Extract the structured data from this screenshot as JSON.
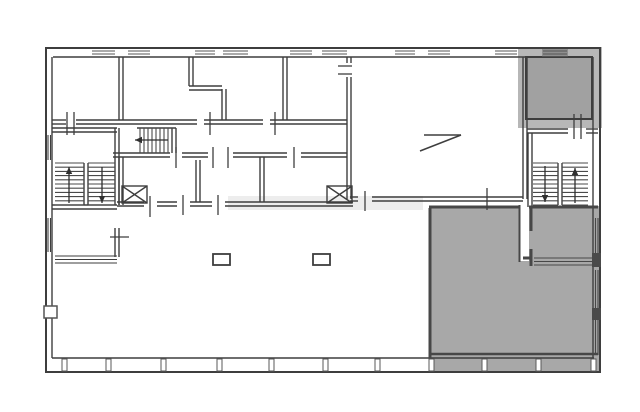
{
  "canvas": {
    "width": 640,
    "height": 412,
    "background": "#ffffff"
  },
  "colors": {
    "wall": "#3e3e3e",
    "gray_wall": "#474747",
    "gray_frame": "#b7b7b7",
    "gray_room": "#a1a1a1",
    "gray_area": "#a8a8a8",
    "pier": "#4a4a4a",
    "white": "#ffffff"
  },
  "plan": {
    "elements": [
      {
        "t": "rect",
        "name": "gray-frame-top-right",
        "x": 518,
        "y": 47,
        "w": 84,
        "h": 81,
        "fill": "#b7b7b7"
      },
      {
        "t": "rect",
        "name": "gray-room-top-right",
        "x": 526,
        "y": 57,
        "w": 66,
        "h": 62,
        "fill": "#a1a1a1",
        "stroke": "#3d3d3d",
        "sw": 2
      },
      {
        "t": "rect",
        "name": "gray-area-bottom-right",
        "x": 429,
        "y": 206,
        "w": 170,
        "h": 166,
        "fill": "#a8a8a8"
      },
      {
        "t": "rect",
        "name": "stair-access-strip",
        "x": 519,
        "y": 133,
        "w": 10,
        "h": 128,
        "fill": "#ffffff"
      },
      {
        "t": "rect",
        "name": "watermark",
        "x": 228,
        "y": 196,
        "w": 195,
        "h": 14,
        "fill": "#cccccc",
        "op": 0.35
      },
      {
        "t": "rect",
        "name": "window-dark-top-right",
        "x": 542,
        "y": 48,
        "w": 26,
        "h": 9,
        "fill": "#8f8f8f"
      },
      {
        "t": "rect",
        "name": "outer-wall",
        "x": 46,
        "y": 48,
        "w": 554,
        "h": 324,
        "fill": "none",
        "stroke": "#3e3e3e",
        "sw": 2
      },
      {
        "t": "line",
        "name": "inner-wall-top",
        "x1": 53,
        "y1": 57,
        "x2": 593,
        "y2": 57,
        "w": 1.4
      },
      {
        "t": "line",
        "name": "inner-wall-left",
        "x1": 52,
        "y1": 57,
        "x2": 52,
        "y2": 358,
        "w": 1.4
      },
      {
        "t": "line",
        "name": "inner-wall-right",
        "x1": 593,
        "y1": 57,
        "x2": 593,
        "y2": 358,
        "w": 1.4
      },
      {
        "t": "line",
        "name": "inner-wall-bottom",
        "x1": 52,
        "y1": 358,
        "x2": 594,
        "y2": 358,
        "w": 1.4
      },
      {
        "t": "topwins",
        "name": "top-window",
        "spans": [
          [
            92,
            115
          ],
          [
            128,
            150
          ],
          [
            195,
            215
          ],
          [
            223,
            248
          ],
          [
            290,
            312
          ],
          [
            322,
            347
          ],
          [
            395,
            415
          ],
          [
            428,
            450
          ],
          [
            495,
            517
          ],
          [
            543,
            567
          ]
        ],
        "ya": 51,
        "yb": 54
      },
      {
        "t": "mullions",
        "name": "bottom-mullion",
        "xs": [
          62,
          106,
          161,
          217,
          269,
          323,
          375,
          429,
          482,
          536,
          591
        ],
        "y": 359,
        "h": 12
      },
      {
        "t": "dwall",
        "name": "wall-topband-bottom",
        "x1": 52,
        "y1": 120,
        "x2": 66,
        "y2": 120
      },
      {
        "t": "dwall",
        "name": "wall-topband-bottom",
        "x1": 76,
        "y1": 120,
        "x2": 197,
        "y2": 120
      },
      {
        "t": "dwall",
        "name": "wall-topband-bottom",
        "x1": 204,
        "y1": 120,
        "x2": 263,
        "y2": 120
      },
      {
        "t": "dwall",
        "name": "wall-topband-bottom",
        "x1": 270,
        "y1": 120,
        "x2": 347,
        "y2": 120
      },
      {
        "t": "dwall",
        "name": "wall-room1-right",
        "x1": 119,
        "y1": 57,
        "x2": 119,
        "y2": 120
      },
      {
        "t": "dwall",
        "name": "wall-room2-right-upper",
        "x1": 189,
        "y1": 57,
        "x2": 189,
        "y2": 86
      },
      {
        "t": "dwall",
        "name": "wall-room2-step",
        "x1": 189,
        "y1": 86,
        "x2": 222,
        "y2": 86
      },
      {
        "t": "dwall",
        "name": "wall-room2-right-lower",
        "x1": 222,
        "y1": 89,
        "x2": 222,
        "y2": 120
      },
      {
        "t": "dwall",
        "name": "wall-room3-right",
        "x1": 283,
        "y1": 57,
        "x2": 283,
        "y2": 120
      },
      {
        "t": "dwall",
        "name": "wall-bigroom-left",
        "x1": 347,
        "y1": 77,
        "x2": 347,
        "y2": 199
      },
      {
        "t": "dwall",
        "name": "wall-bigroom-left-stub",
        "x1": 347,
        "y1": 57,
        "x2": 347,
        "y2": 63
      },
      {
        "t": "dwall",
        "name": "wall-bigroom-right",
        "x1": 523,
        "y1": 57,
        "x2": 523,
        "y2": 199
      },
      {
        "t": "dwall",
        "name": "wall-bigroom-bottom",
        "x1": 350,
        "y1": 197,
        "x2": 358,
        "y2": 197
      },
      {
        "t": "dwall",
        "name": "wall-bigroom-bottom",
        "x1": 372,
        "y1": 197,
        "x2": 523,
        "y2": 197
      },
      {
        "t": "dwall",
        "name": "wall-corridor-bottom",
        "x1": 113,
        "y1": 153,
        "x2": 170,
        "y2": 153
      },
      {
        "t": "dwall",
        "name": "wall-corridor-bottom",
        "x1": 182,
        "y1": 153,
        "x2": 208,
        "y2": 153
      },
      {
        "t": "dwall",
        "name": "wall-corridor-bottom",
        "x1": 233,
        "y1": 153,
        "x2": 287,
        "y2": 153
      },
      {
        "t": "dwall",
        "name": "wall-corridor-bottom",
        "x1": 301,
        "y1": 153,
        "x2": 347,
        "y2": 153
      },
      {
        "t": "dwall",
        "name": "wall-landing-top",
        "x1": 52,
        "y1": 128,
        "x2": 117,
        "y2": 128
      },
      {
        "t": "dwall",
        "name": "wall-leftstair-right",
        "x1": 115,
        "y1": 128,
        "x2": 115,
        "y2": 205
      },
      {
        "t": "dwall",
        "name": "wall-leftstair-bottom",
        "x1": 52,
        "y1": 205,
        "x2": 117,
        "y2": 205
      },
      {
        "t": "dwall",
        "name": "wall-leftroom-right",
        "x1": 115,
        "y1": 228,
        "x2": 115,
        "y2": 257
      },
      {
        "t": "dwall",
        "name": "wall-midband-left",
        "x1": 119,
        "y1": 157,
        "x2": 119,
        "y2": 205
      },
      {
        "t": "dwall",
        "name": "wall-midband-1",
        "x1": 196,
        "y1": 160,
        "x2": 196,
        "y2": 202
      },
      {
        "t": "dwall",
        "name": "wall-midband-2",
        "x1": 260,
        "y1": 157,
        "x2": 260,
        "y2": 202
      },
      {
        "t": "dwall",
        "name": "wall-midband-bottom",
        "x1": 117,
        "y1": 202,
        "x2": 144,
        "y2": 202
      },
      {
        "t": "dwall",
        "name": "wall-midband-bottom",
        "x1": 157,
        "y1": 202,
        "x2": 177,
        "y2": 202
      },
      {
        "t": "dwall",
        "name": "wall-midband-bottom",
        "x1": 190,
        "y1": 202,
        "x2": 212,
        "y2": 202
      },
      {
        "t": "dwall",
        "name": "wall-midband-bottom",
        "x1": 225,
        "y1": 202,
        "x2": 353,
        "y2": 202
      },
      {
        "t": "dwall",
        "name": "wall-leftstair-divider",
        "x1": 84,
        "y1": 163,
        "x2": 84,
        "y2": 205
      },
      {
        "t": "dwall",
        "name": "wall-rightstair-divider",
        "x1": 558,
        "y1": 163,
        "x2": 558,
        "y2": 205
      },
      {
        "t": "dwall",
        "name": "wall-midstair-right",
        "x1": 172,
        "y1": 128,
        "x2": 172,
        "y2": 153
      },
      {
        "t": "line",
        "name": "wall-midstair-top",
        "x1": 137,
        "y1": 128,
        "x2": 176,
        "y2": 128,
        "w": 1.4
      },
      {
        "t": "dwall",
        "name": "wall-stairwell-top",
        "x1": 527,
        "y1": 129,
        "x2": 568,
        "y2": 129
      },
      {
        "t": "dwall",
        "name": "wall-stairwell-top",
        "x1": 586,
        "y1": 129,
        "x2": 598,
        "y2": 129
      },
      {
        "t": "dwall",
        "name": "wall-stairwell-left",
        "x1": 528,
        "y1": 133,
        "x2": 528,
        "y2": 207
      },
      {
        "t": "wlines",
        "name": "window-band-leftroom",
        "dir": "h",
        "a1": 55,
        "a2": 117,
        "ks": [
          256,
          259.5,
          263
        ]
      },
      {
        "t": "wlines",
        "name": "window-band-leftwall-landing",
        "dir": "v",
        "a1": 135,
        "a2": 160,
        "ks": [
          48,
          50.5
        ]
      },
      {
        "t": "wlines",
        "name": "window-band-leftwall-lower",
        "dir": "v",
        "a1": 218,
        "a2": 252,
        "ks": [
          48,
          50.5
        ]
      },
      {
        "t": "line",
        "name": "gray-wall-top",
        "x1": 429,
        "y1": 207,
        "x2": 519,
        "y2": 207,
        "w": 3,
        "c": "#474747"
      },
      {
        "t": "line",
        "name": "gray-wall-top",
        "x1": 529,
        "y1": 207,
        "x2": 598,
        "y2": 207,
        "w": 3,
        "c": "#474747"
      },
      {
        "t": "line",
        "name": "gray-wall-left",
        "x1": 430,
        "y1": 208,
        "x2": 430,
        "y2": 358,
        "w": 3,
        "c": "#474747"
      },
      {
        "t": "line",
        "name": "gray-strip-edge",
        "x1": 519.5,
        "y1": 205,
        "x2": 519.5,
        "y2": 262,
        "w": 2,
        "c": "#474747"
      },
      {
        "t": "line",
        "name": "gray-subroom-wall",
        "x1": 531,
        "y1": 208,
        "x2": 531,
        "y2": 231,
        "w": 3,
        "c": "#474747"
      },
      {
        "t": "line",
        "name": "gray-subroom-wall",
        "x1": 531,
        "y1": 249,
        "x2": 531,
        "y2": 266,
        "w": 3,
        "c": "#474747"
      },
      {
        "t": "line",
        "name": "gray-subroom-foot",
        "x1": 523,
        "y1": 258,
        "x2": 531,
        "y2": 258,
        "w": 3,
        "c": "#474747"
      },
      {
        "t": "wlines",
        "name": "window-band-subroom",
        "dir": "h",
        "a1": 534,
        "a2": 592,
        "ks": [
          258,
          261.5,
          265
        ],
        "c": "#474747"
      },
      {
        "t": "wlines",
        "name": "window-band-right-1",
        "dir": "v",
        "a1": 218,
        "a2": 253,
        "ks": [
          595.5,
          598
        ],
        "c": "#474747"
      },
      {
        "t": "wlines",
        "name": "window-band-right-2",
        "dir": "v",
        "a1": 270,
        "a2": 310,
        "ks": [
          595.5,
          598
        ],
        "c": "#474747"
      },
      {
        "t": "wlines",
        "name": "window-band-right-3",
        "dir": "v",
        "a1": 320,
        "a2": 355,
        "ks": [
          595.5,
          598
        ],
        "c": "#474747"
      },
      {
        "t": "rect",
        "name": "wall-pier",
        "x": 592,
        "y": 253,
        "w": 9,
        "h": 14,
        "fill": "#4a4a4a"
      },
      {
        "t": "rect",
        "name": "wall-pier",
        "x": 592,
        "y": 308,
        "w": 9,
        "h": 12,
        "fill": "#4a4a4a"
      },
      {
        "t": "line",
        "name": "gray-wall-bottom",
        "x1": 430,
        "y1": 354,
        "x2": 598,
        "y2": 354,
        "w": 2.5,
        "c": "#474747"
      },
      {
        "t": "stair",
        "name": "stair-left-up-flight",
        "x": 55,
        "y": 163,
        "w": 29,
        "h": 42,
        "n": 10,
        "dir": "h"
      },
      {
        "t": "stair",
        "name": "stair-left-down-flight",
        "x": 88,
        "y": 163,
        "w": 27,
        "h": 42,
        "n": 10,
        "dir": "h"
      },
      {
        "t": "stair",
        "name": "stair-corridor-flight",
        "x": 140,
        "y": 128,
        "w": 32,
        "h": 25,
        "n": 8,
        "dir": "v"
      },
      {
        "t": "stair",
        "name": "stair-right-down-flight",
        "x": 533,
        "y": 163,
        "w": 25,
        "h": 42,
        "n": 10,
        "dir": "h"
      },
      {
        "t": "stair",
        "name": "stair-right-up-flight",
        "x": 562,
        "y": 163,
        "w": 26,
        "h": 42,
        "n": 10,
        "dir": "h"
      },
      {
        "t": "arrow",
        "name": "stair-arrow-up",
        "x1": 69,
        "y1": 203,
        "x2": 69,
        "y2": 167
      },
      {
        "t": "arrow",
        "name": "stair-arrow-down",
        "x1": 102,
        "y1": 167,
        "x2": 102,
        "y2": 203
      },
      {
        "t": "arrow",
        "name": "stair-arrow-left",
        "x1": 168,
        "y1": 140,
        "x2": 135,
        "y2": 140
      },
      {
        "t": "arrow",
        "name": "stair-arrow-down",
        "x1": 545,
        "y1": 166,
        "x2": 545,
        "y2": 202
      },
      {
        "t": "arrow",
        "name": "stair-arrow-up",
        "x1": 575,
        "y1": 203,
        "x2": 575,
        "y2": 168
      },
      {
        "t": "xbox",
        "name": "shaft-x-left",
        "x": 122,
        "y": 186,
        "w": 25,
        "h": 17
      },
      {
        "t": "xbox",
        "name": "shaft-x-right",
        "x": 327,
        "y": 186,
        "w": 25,
        "h": 17
      },
      {
        "t": "rect",
        "name": "column",
        "x": 213,
        "y": 254,
        "w": 17,
        "h": 11,
        "fill": "#ffffff",
        "stroke": "#3e3e3e",
        "sw": 1.8
      },
      {
        "t": "rect",
        "name": "column",
        "x": 313,
        "y": 254,
        "w": 17,
        "h": 11,
        "fill": "#ffffff",
        "stroke": "#3e3e3e",
        "sw": 1.8
      },
      {
        "t": "line",
        "name": "ramp-symbol",
        "x1": 424,
        "y1": 135,
        "x2": 461,
        "y2": 135,
        "w": 1.5
      },
      {
        "t": "line",
        "name": "ramp-symbol",
        "x1": 420,
        "y1": 151,
        "x2": 461,
        "y2": 135,
        "w": 1.5
      },
      {
        "t": "line",
        "name": "door-tick",
        "x1": 67,
        "y1": 112,
        "x2": 67,
        "y2": 135,
        "w": 1.3
      },
      {
        "t": "line",
        "name": "door-tick",
        "x1": 74,
        "y1": 112,
        "x2": 74,
        "y2": 135,
        "w": 1.3
      },
      {
        "t": "line",
        "name": "door-tick",
        "x1": 210,
        "y1": 112,
        "x2": 210,
        "y2": 135,
        "w": 1.3
      },
      {
        "t": "line",
        "name": "door-tick",
        "x1": 275,
        "y1": 112,
        "x2": 275,
        "y2": 135,
        "w": 1.3
      },
      {
        "t": "line",
        "name": "door-tick",
        "x1": 338,
        "y1": 66,
        "x2": 352,
        "y2": 66,
        "w": 1.3
      },
      {
        "t": "line",
        "name": "door-tick",
        "x1": 338,
        "y1": 74,
        "x2": 352,
        "y2": 74,
        "w": 1.3
      },
      {
        "t": "line",
        "name": "door-tick",
        "x1": 176,
        "y1": 147,
        "x2": 176,
        "y2": 168,
        "w": 1.3
      },
      {
        "t": "line",
        "name": "door-tick",
        "x1": 213,
        "y1": 147,
        "x2": 213,
        "y2": 168,
        "w": 1.3
      },
      {
        "t": "line",
        "name": "door-tick",
        "x1": 228,
        "y1": 147,
        "x2": 228,
        "y2": 168,
        "w": 1.3
      },
      {
        "t": "line",
        "name": "door-tick",
        "x1": 294,
        "y1": 147,
        "x2": 294,
        "y2": 168,
        "w": 1.3
      },
      {
        "t": "line",
        "name": "door-tick",
        "x1": 150,
        "y1": 196,
        "x2": 150,
        "y2": 217,
        "w": 1.3
      },
      {
        "t": "line",
        "name": "door-tick",
        "x1": 183,
        "y1": 195,
        "x2": 183,
        "y2": 215,
        "w": 1.3
      },
      {
        "t": "line",
        "name": "door-tick",
        "x1": 218,
        "y1": 195,
        "x2": 218,
        "y2": 215,
        "w": 1.3
      },
      {
        "t": "line",
        "name": "door-tick",
        "x1": 365,
        "y1": 191,
        "x2": 365,
        "y2": 211,
        "w": 1.3
      },
      {
        "t": "line",
        "name": "door-tick",
        "x1": 487,
        "y1": 188,
        "x2": 487,
        "y2": 210,
        "w": 1.3
      },
      {
        "t": "line",
        "name": "door-tick",
        "x1": 574,
        "y1": 114,
        "x2": 574,
        "y2": 139,
        "w": 1.3
      },
      {
        "t": "line",
        "name": "door-tick",
        "x1": 581,
        "y1": 114,
        "x2": 581,
        "y2": 139,
        "w": 1.3
      },
      {
        "t": "line",
        "name": "door-tick",
        "x1": 110,
        "y1": 237,
        "x2": 129,
        "y2": 237,
        "w": 1.3
      },
      {
        "t": "rect",
        "name": "wall-notch",
        "x": 44,
        "y": 306,
        "w": 13,
        "h": 12,
        "fill": "#ffffff",
        "stroke": "#555555",
        "sw": 1.5
      }
    ]
  }
}
